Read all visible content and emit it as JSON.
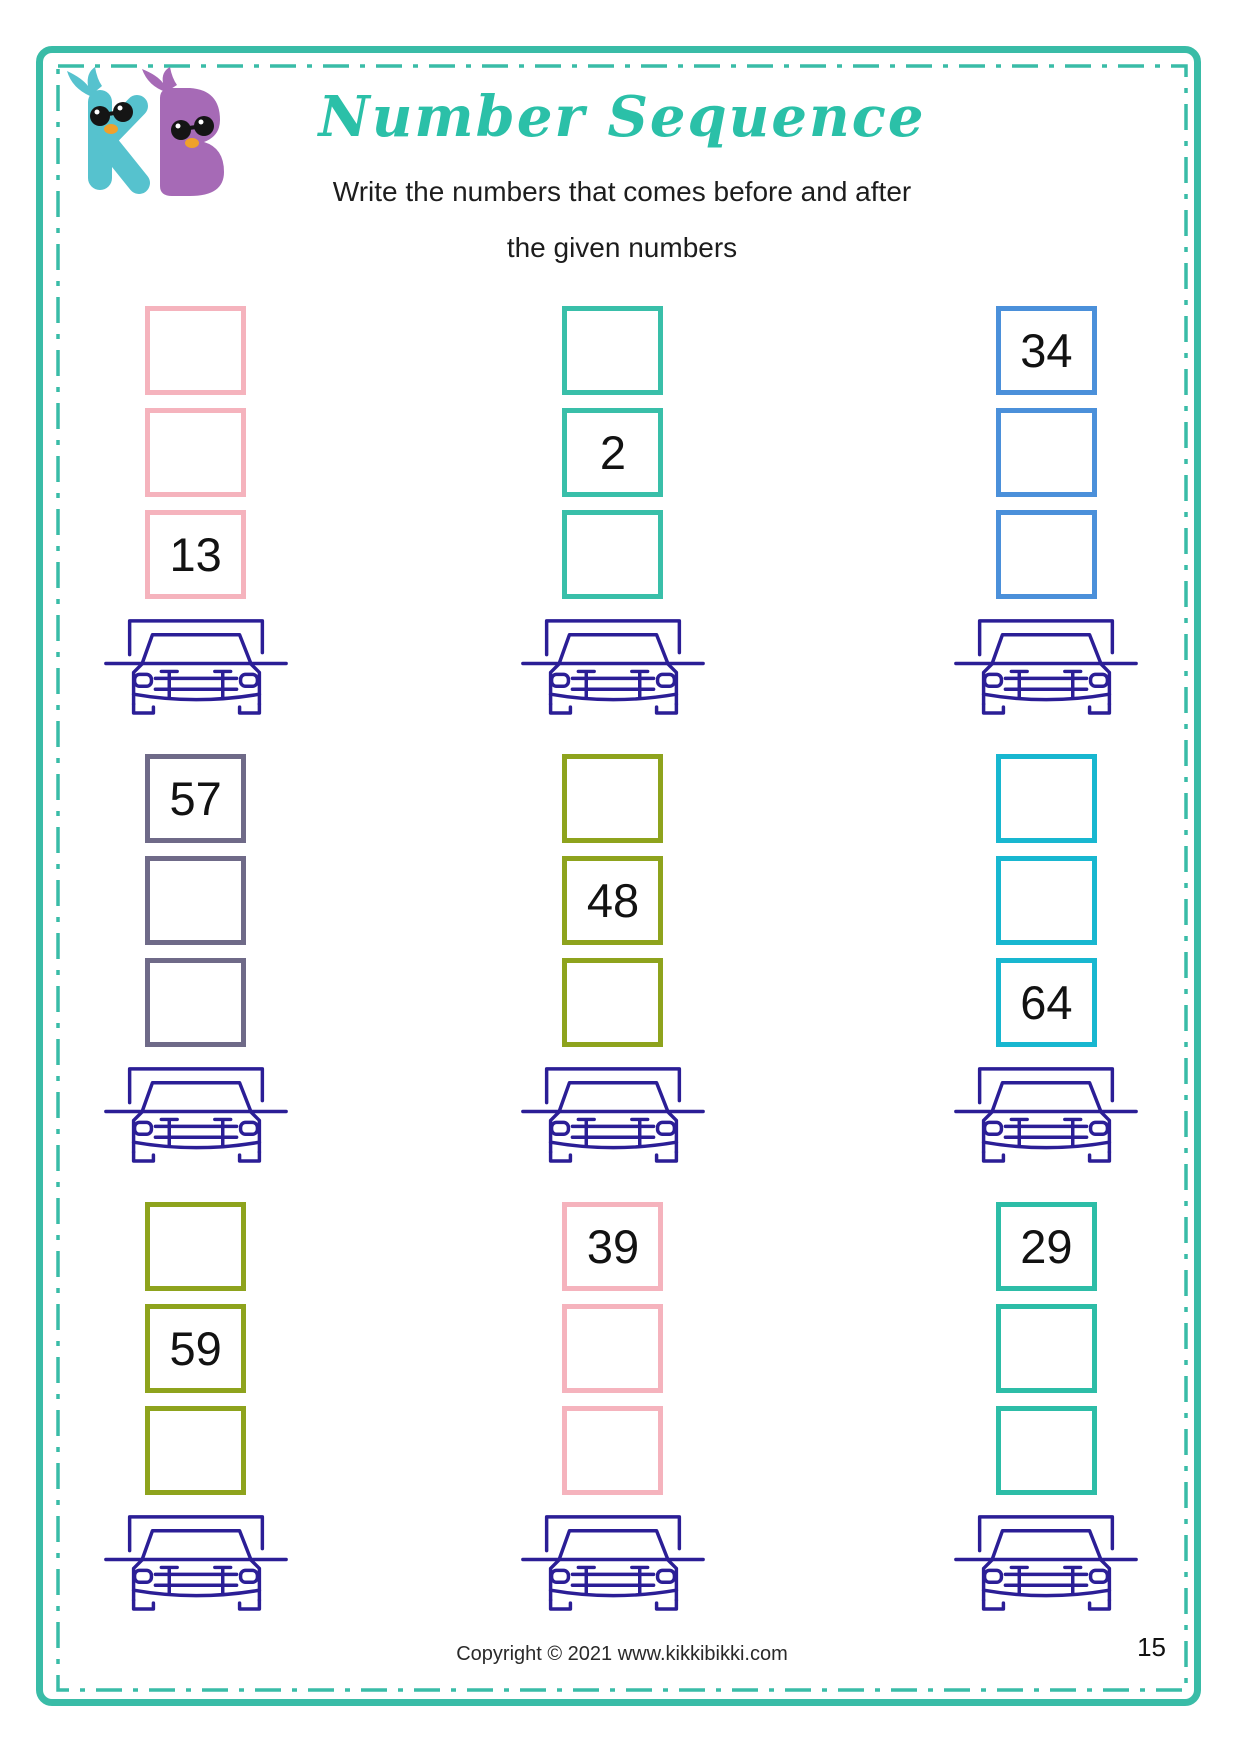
{
  "header": {
    "title": "Number Sequence",
    "instruction_line1": "Write the numbers that comes before and after",
    "instruction_line2": "the given numbers",
    "logo_text": "KB"
  },
  "palette": {
    "page_border": "#39bca7",
    "title_text": "#2bc0a8",
    "car_outline": "#2b1e96",
    "logo_teal": "#56c2ce",
    "logo_purple": "#a66ab6",
    "logo_beak_orange": "#f0a12b"
  },
  "problems": [
    {
      "color": "#f5b3bd",
      "boxes": [
        "",
        "",
        "13"
      ]
    },
    {
      "color": "#39bfa9",
      "boxes": [
        "",
        "2",
        ""
      ]
    },
    {
      "color": "#4b90da",
      "boxes": [
        "34",
        "",
        ""
      ]
    },
    {
      "color": "#6f6a88",
      "boxes": [
        "57",
        "",
        ""
      ]
    },
    {
      "color": "#8ea31d",
      "boxes": [
        "",
        "48",
        ""
      ]
    },
    {
      "color": "#18b7d0",
      "boxes": [
        "",
        "",
        "64"
      ]
    },
    {
      "color": "#8ea31d",
      "boxes": [
        "",
        "59",
        ""
      ]
    },
    {
      "color": "#f5b3bd",
      "boxes": [
        "39",
        "",
        ""
      ]
    },
    {
      "color": "#2dbda7",
      "boxes": [
        "29",
        "",
        ""
      ]
    }
  ],
  "footer": {
    "copyright": "Copyright © 2021 www.kikkibikki.com",
    "page_number": "15"
  }
}
